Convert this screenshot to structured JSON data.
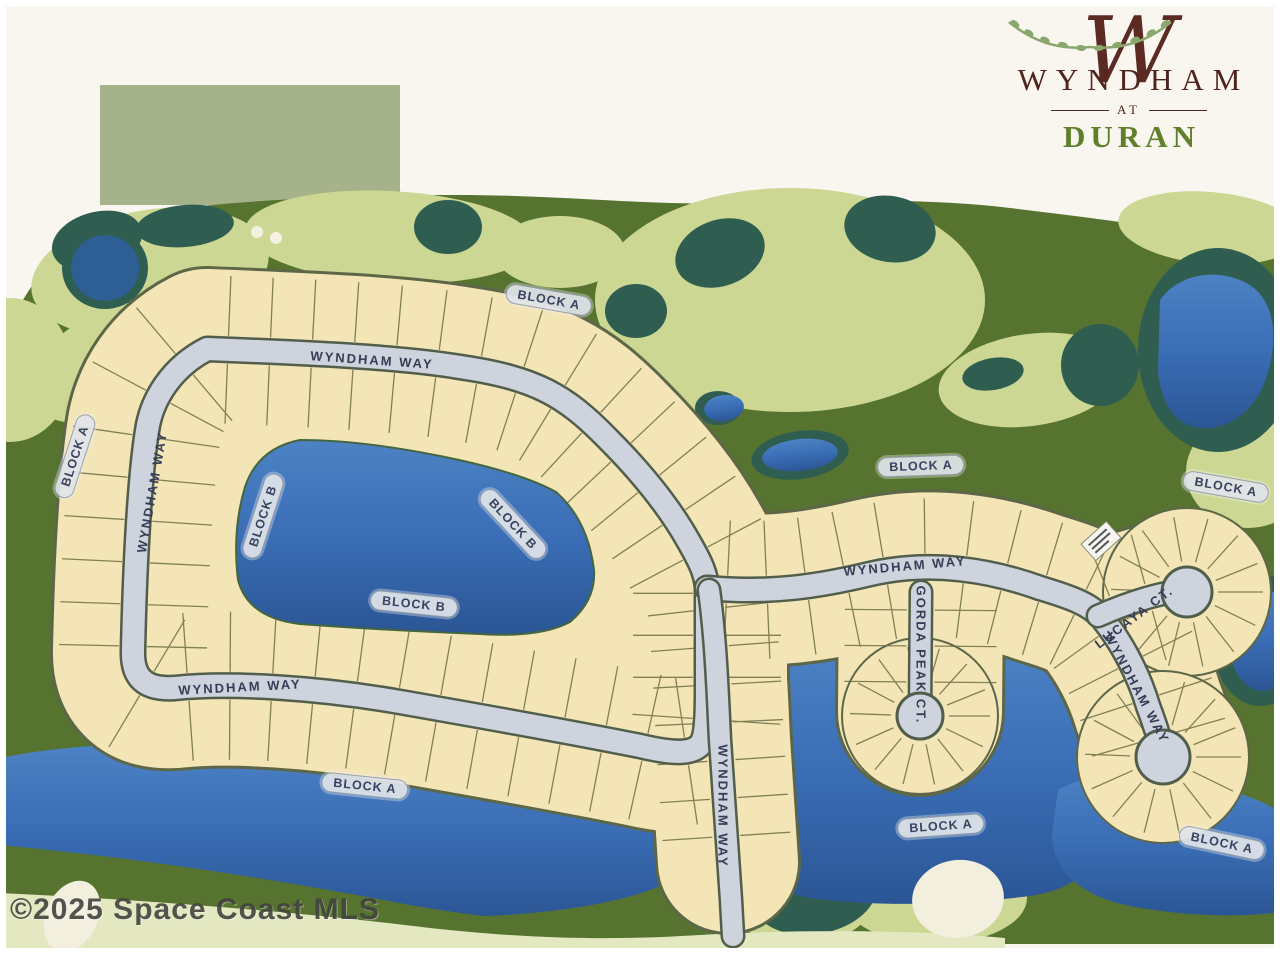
{
  "logo": {
    "monogram": "W",
    "title": "WYNDHAM",
    "connector": "AT",
    "subtitle": "DURAN"
  },
  "watermark": "©2025 Space Coast MLS",
  "street_labels": {
    "wyndham_top": "WYNDHAM WAY",
    "wyndham_left": "WYNDHAM WAY",
    "wyndham_bottom": "WYNDHAM WAY",
    "wyndham_right": "WYNDHAM WAY",
    "wyndham_center": "WYNDHAM WAY",
    "wyndham_southeast": "WYNDHAM WAY",
    "gorda_peak": "GORDA PEAK CT.",
    "lucaya": "LUCAYA CT."
  },
  "block_labels": {
    "a_top": "BLOCK A",
    "a_west": "BLOCK A",
    "a_mid": "BLOCK A",
    "a_east": "BLOCK A",
    "a_south_west": "BLOCK A",
    "a_south_mid": "BLOCK A",
    "a_south_east": "BLOCK A",
    "b_lake_west": "BLOCK B",
    "b_lake_diag": "BLOCK B",
    "b_lake_south": "BLOCK B"
  },
  "colors": {
    "logo_maroon": "#5b2a22",
    "logo_green": "#5f7f2c",
    "golf_dark_green": "#567430",
    "fairway_green": "#ccd794",
    "tree_teal": "#2f5e51",
    "lake_blue": "#3a6db5",
    "lot_cream": "#f3e5b6",
    "road_gray": "#ced3de",
    "pill_gray": "#e0e4ea"
  }
}
